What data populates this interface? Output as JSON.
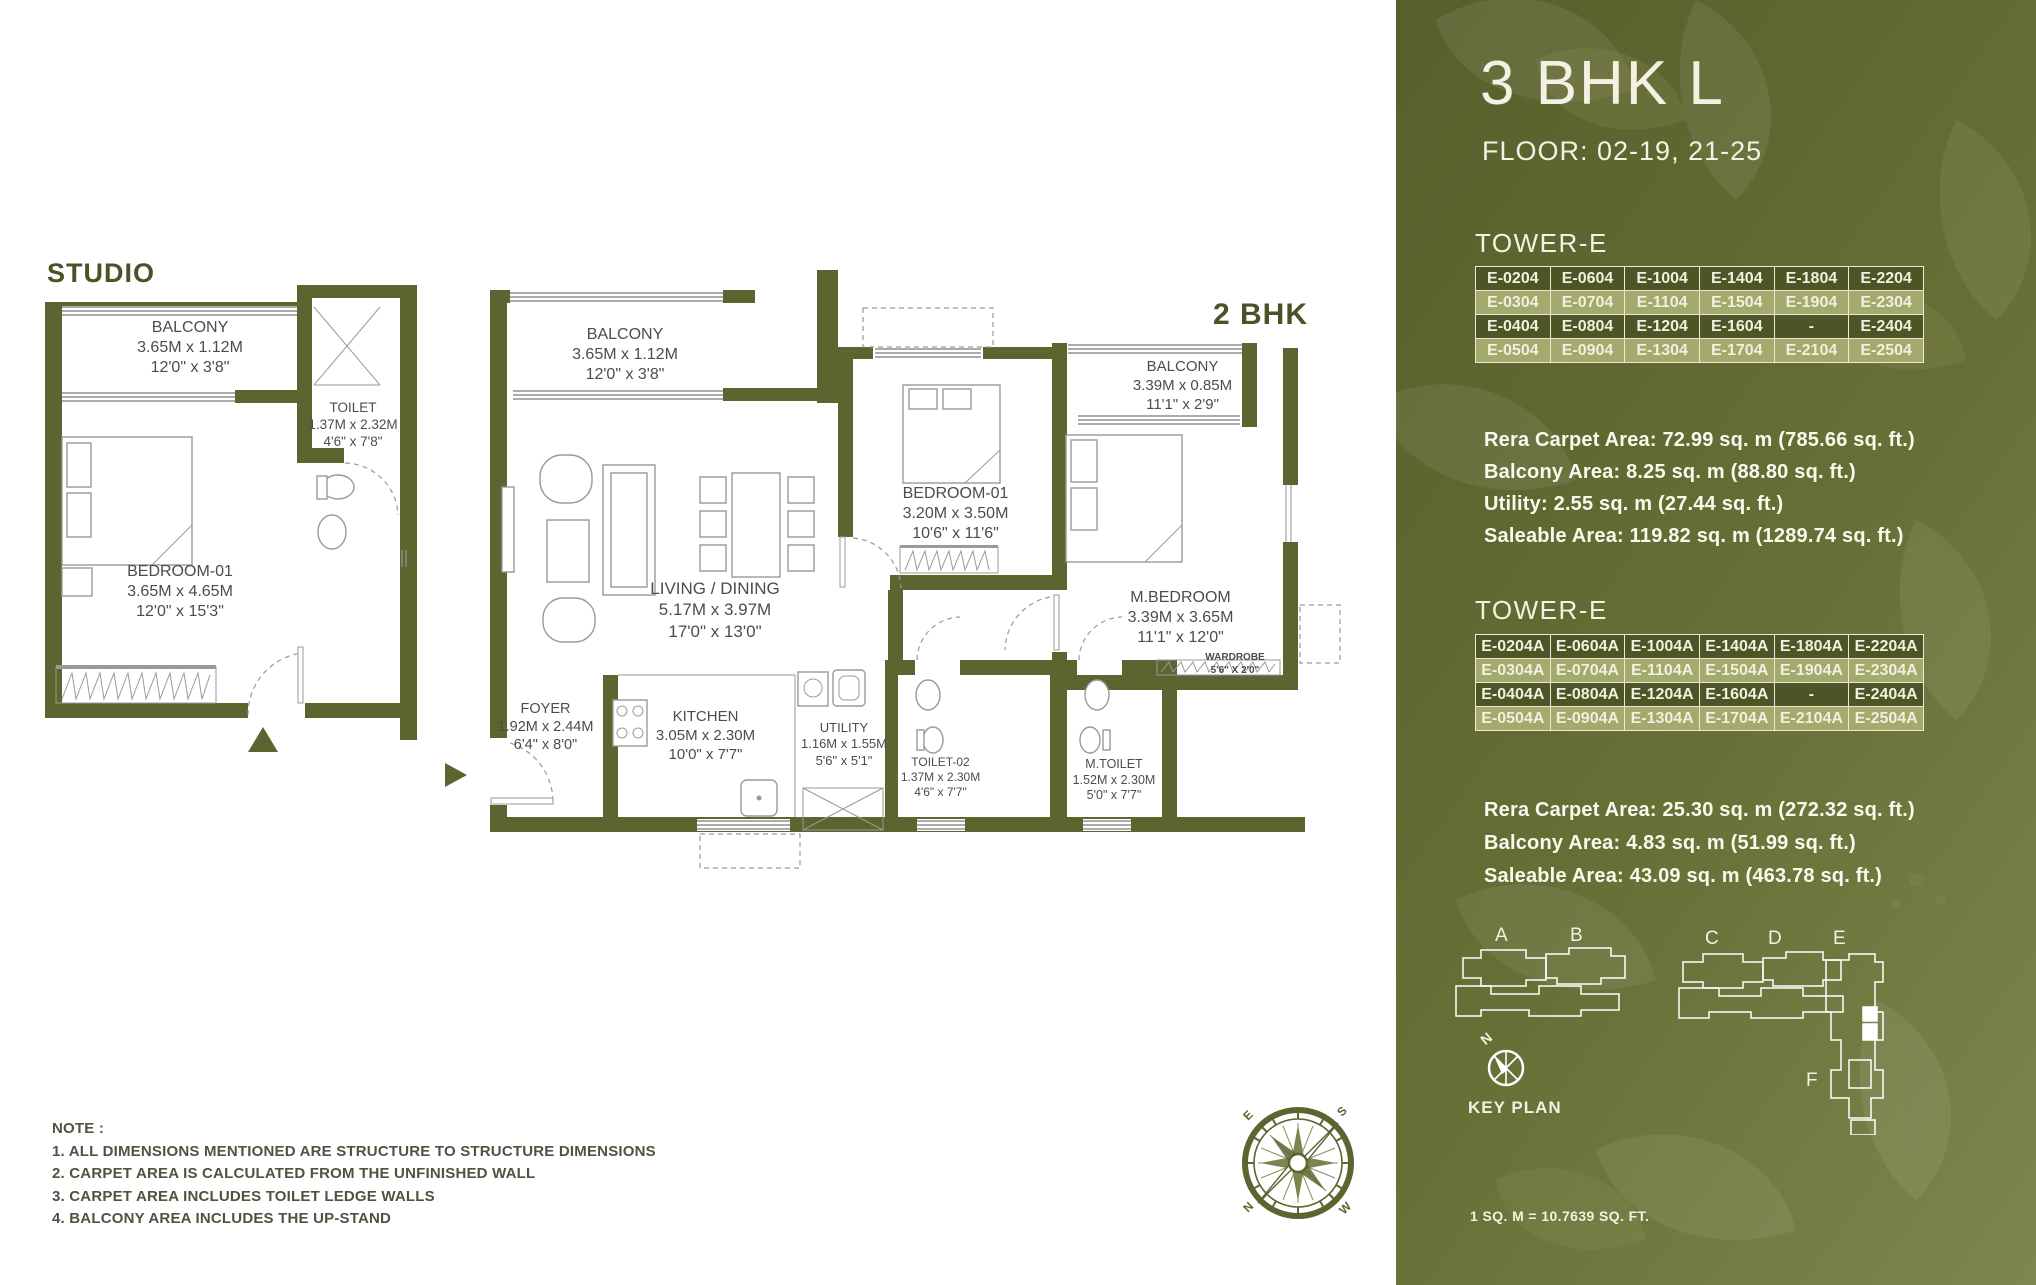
{
  "plans": {
    "studio": {
      "title": "STUDIO",
      "rooms": {
        "balcony": {
          "name": "BALCONY",
          "m": "3.65M x 1.12M",
          "ft": "12'0\" x 3'8\""
        },
        "toilet": {
          "name": "TOILET",
          "m": "1.37M x 2.32M",
          "ft": "4'6\" x 7'8\""
        },
        "bedroom": {
          "name": "BEDROOM-01",
          "m": "3.65M x 4.65M",
          "ft": "12'0\" x 15'3\""
        }
      }
    },
    "bhk2": {
      "title": "2 BHK",
      "rooms": {
        "balcony1": {
          "name": "BALCONY",
          "m": "3.65M x 1.12M",
          "ft": "12'0\" x 3'8\""
        },
        "living": {
          "name": "LIVING / DINING",
          "m": "5.17M x 3.97M",
          "ft": "17'0\" x 13'0\""
        },
        "bedroom1": {
          "name": "BEDROOM-01",
          "m": "3.20M x 3.50M",
          "ft": "10'6\" x 11'6\""
        },
        "balcony2": {
          "name": "BALCONY",
          "m": "3.39M x 0.85M",
          "ft": "11'1\" x 2'9\""
        },
        "mbedroom": {
          "name": "M.BEDROOM",
          "m": "3.39M x 3.65M",
          "ft": "11'1\" x 12'0\""
        },
        "foyer": {
          "name": "FOYER",
          "m": "1.92M x 2.44M",
          "ft": "6'4\" x 8'0\""
        },
        "kitchen": {
          "name": "KITCHEN",
          "m": "3.05M x 2.30M",
          "ft": "10'0\" x 7'7\""
        },
        "utility": {
          "name": "UTILITY",
          "m": "1.16M x 1.55M",
          "ft": "5'6\" x 5'1\""
        },
        "toilet2": {
          "name": "TOILET-02",
          "m": "1.37M x 2.30M",
          "ft": "4'6\" x 7'7\""
        },
        "mtoilet": {
          "name": "M.TOILET",
          "m": "1.52M x 2.30M",
          "ft": "5'0\" x 7'7\""
        },
        "wardrobe": {
          "name": "WARDROBE",
          "ft": "5'6\" X 2'0\""
        }
      }
    },
    "compass": {
      "n": "N",
      "e": "E",
      "s": "S",
      "w": "W"
    }
  },
  "note": {
    "heading": "NOTE :",
    "items": [
      "1. ALL DIMENSIONS MENTIONED ARE STRUCTURE TO STRUCTURE DIMENSIONS",
      "2. CARPET AREA IS CALCULATED FROM THE UNFINISHED WALL",
      "3. CARPET AREA INCLUDES TOILET LEDGE WALLS",
      "4. BALCONY AREA INCLUDES THE UP-STAND"
    ]
  },
  "panel": {
    "title": "3 BHK L",
    "floor": "FLOOR: 02-19, 21-25",
    "tower1": {
      "heading": "TOWER-E",
      "rows": [
        [
          "E-0204",
          "E-0604",
          "E-1004",
          "E-1404",
          "E-1804",
          "E-2204"
        ],
        [
          "E-0304",
          "E-0704",
          "E-1104",
          "E-1504",
          "E-1904",
          "E-2304"
        ],
        [
          "E-0404",
          "E-0804",
          "E-1204",
          "E-1604",
          "-",
          "E-2404"
        ],
        [
          "E-0504",
          "E-0904",
          "E-1304",
          "E-1704",
          "E-2104",
          "E-2504"
        ]
      ]
    },
    "areas1": [
      "Rera Carpet Area: 72.99 sq. m (785.66 sq. ft.)",
      "Balcony Area: 8.25 sq. m (88.80 sq. ft.)",
      "Utility: 2.55 sq. m (27.44 sq. ft.)",
      "Saleable Area: 119.82 sq. m (1289.74 sq. ft.)"
    ],
    "tower2": {
      "heading": "TOWER-E",
      "rows": [
        [
          "E-0204A",
          "E-0604A",
          "E-1004A",
          "E-1404A",
          "E-1804A",
          "E-2204A"
        ],
        [
          "E-0304A",
          "E-0704A",
          "E-1104A",
          "E-1504A",
          "E-1904A",
          "E-2304A"
        ],
        [
          "E-0404A",
          "E-0804A",
          "E-1204A",
          "E-1604A",
          "-",
          "E-2404A"
        ],
        [
          "E-0504A",
          "E-0904A",
          "E-1304A",
          "E-1704A",
          "E-2104A",
          "E-2504A"
        ]
      ]
    },
    "areas2": [
      "Rera Carpet Area: 25.30 sq. m (272.32 sq. ft.)",
      "Balcony Area: 4.83 sq. m (51.99 sq. ft.)",
      "Saleable Area: 43.09 sq. m (463.78 sq. ft.)"
    ],
    "keyplan": {
      "labels": [
        "A",
        "B",
        "C",
        "D",
        "E",
        "F"
      ],
      "north": "N",
      "caption": "KEY PLAN"
    },
    "footer": "1 SQ. M = 10.7639 SQ. FT."
  },
  "colors": {
    "wall": "#5c642f",
    "accent_text": "#4a5226",
    "panel_dark": "#57602d",
    "panel_light": "#7e864f",
    "table_dark": "#4c5525",
    "table_light": "#a4aa6e",
    "cream": "#f2efdf"
  }
}
